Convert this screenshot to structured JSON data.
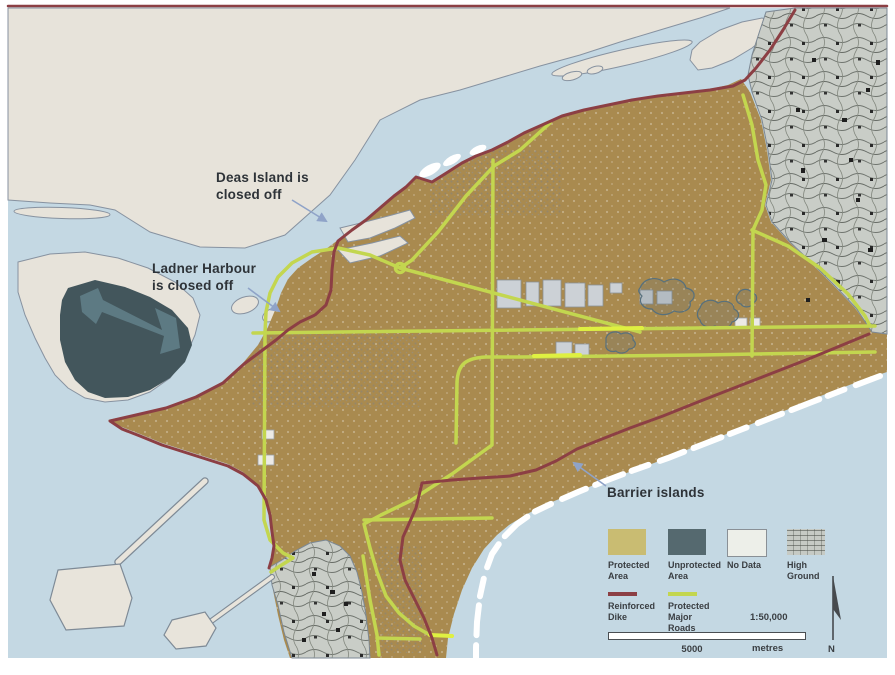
{
  "map": {
    "region_description": "Flood protection map of a river delta",
    "annotations": {
      "deas": "Deas Island is\nclosed off",
      "ladner": "Ladner Harbour\nis closed off",
      "barrier": "Barrier islands"
    },
    "legend": {
      "items": [
        {
          "label": "Protected\nArea",
          "color": "#c9bc72",
          "type": "swatch"
        },
        {
          "label": "Unprotected\nArea",
          "color": "#55696f",
          "type": "swatch"
        },
        {
          "label": "No Data",
          "color": "#edefe9",
          "type": "swatch"
        },
        {
          "label": "High\nGround",
          "color": "#c6cac4",
          "type": "texture-swatch"
        },
        {
          "label": "Reinforced\nDike",
          "color": "#8c3f44",
          "type": "line"
        },
        {
          "label": "Protected\nMajor\nRoads",
          "color": "#c3d64f",
          "type": "line"
        }
      ],
      "scale_ratio": "1:50,000",
      "scale_distance": "5000",
      "scale_unit": "metres",
      "north_label": "N"
    },
    "colors": {
      "water": "#c4d8e3",
      "no_data_land": "#e7e3da",
      "protected_area": "#a98a4f",
      "unprotected_area": "#43565c",
      "unprotected_light": "#5d7a83",
      "high_ground_base": "#c9cdc7",
      "reinforced_dike": "#8c3f44",
      "protected_roads": "#c3d64f",
      "roads_bright": "#dff041",
      "barrier_islands": "#ffffff",
      "annotation_text": "#2e3338",
      "annotation_arrow": "#8fa3c8"
    }
  }
}
